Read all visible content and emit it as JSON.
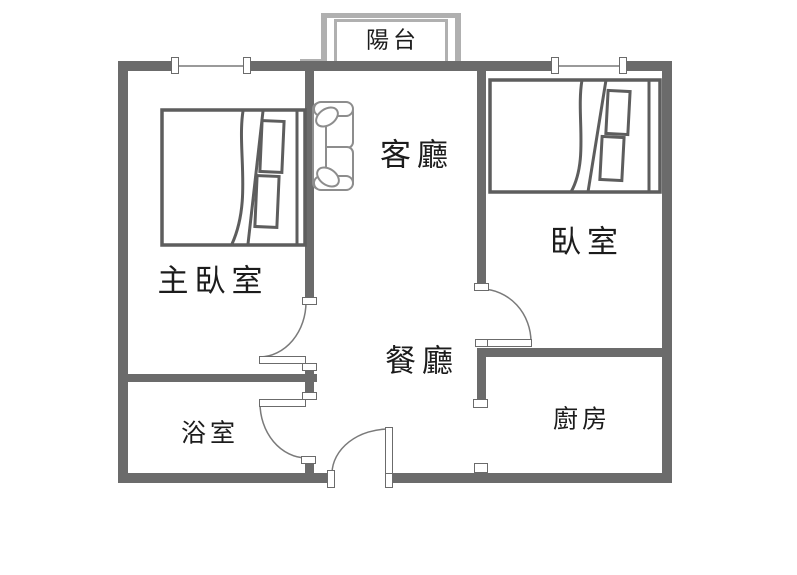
{
  "plan_title": "apartment-floor-plan",
  "rooms": {
    "balcony": {
      "label": "陽台"
    },
    "living_room": {
      "label": "客廳"
    },
    "bedroom": {
      "label": "臥室"
    },
    "master_bedroom": {
      "label": "主臥室"
    },
    "dining_room": {
      "label": "餐廳"
    },
    "bathroom": {
      "label": "浴室"
    },
    "kitchen": {
      "label": "廚房"
    }
  },
  "furniture": [
    "master-bed",
    "bedroom-bed",
    "sofa"
  ],
  "openings": [
    "master-bedroom-door",
    "bathroom-door",
    "bedroom-door",
    "entrance-door",
    "kitchen-passage",
    "window-master",
    "window-bedroom"
  ],
  "colors": {
    "wall": "#6b6b6b",
    "balcony_wall": "#b0b0b0",
    "furniture_outline": "#8d8d8d",
    "bed_outline": "#5d5d5d",
    "door_arc": "#7a7a7a",
    "window_line": "#9a9a9a",
    "text": "#1c1c1c",
    "background": "#ffffff"
  }
}
